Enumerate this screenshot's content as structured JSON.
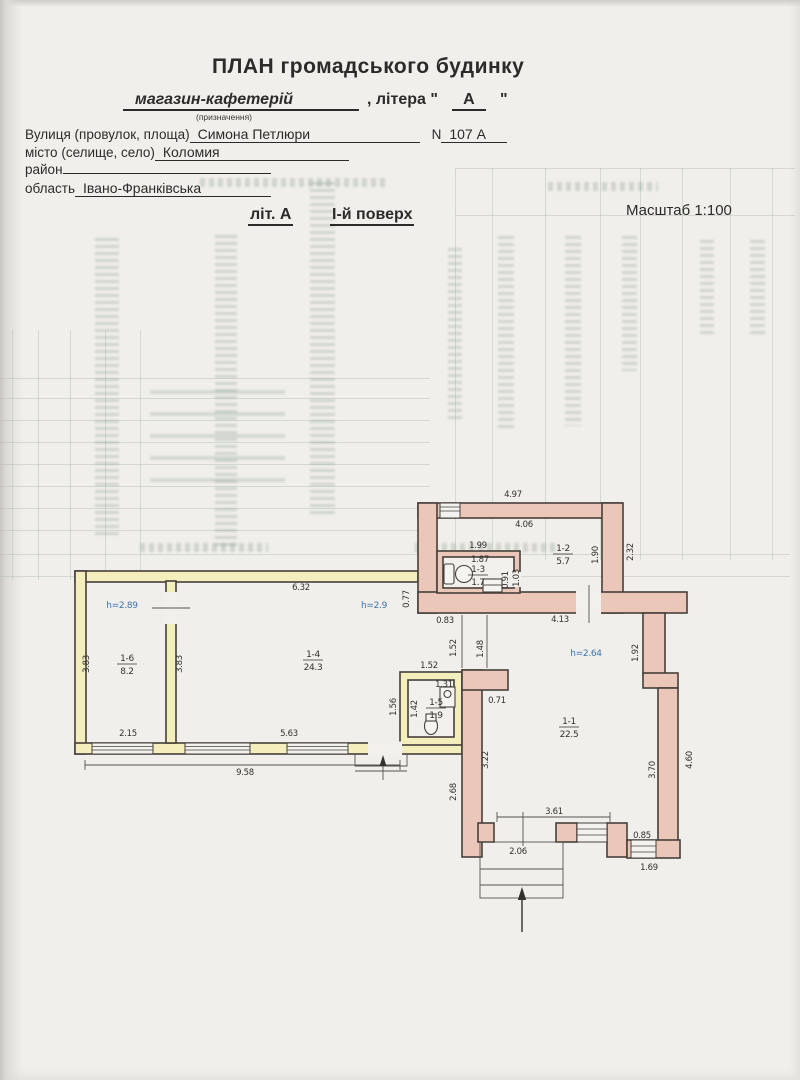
{
  "header": {
    "title": "ПЛАН  громадського будинку",
    "purpose_value": "магазин-кафетерій",
    "purpose_caption": "(призначення)",
    "letter_prefix": ", літера \"",
    "letter_value": "А",
    "letter_suffix": "\"",
    "street_label": "Вулиця (провулок, площа)",
    "street_value": "Симона Петлюри",
    "number_label": "N",
    "number_value": "107 А",
    "city_label": "місто (селище, село)",
    "city_value": "Коломия",
    "district_label": "район",
    "district_value": "",
    "region_label": "область",
    "region_value": "Івано-Франківська"
  },
  "subtitle": {
    "sheet_label": "літ. А",
    "floor_label": "І-й поверх",
    "scale_label": "Масштаб 1:100"
  },
  "plan": {
    "colors": {
      "wall_pink": "#ebc7ba",
      "wall_yellow": "#f3eebc",
      "height_text": "#3f74a6"
    },
    "rooms": [
      {
        "number": "1-1",
        "area": "22.5",
        "x": 569,
        "y": 724
      },
      {
        "number": "1-2",
        "area": "5.7",
        "x": 563,
        "y": 551
      },
      {
        "number": "1-3",
        "area": "1.7",
        "x": 478,
        "y": 572
      },
      {
        "number": "1-4",
        "area": "24.3",
        "x": 313,
        "y": 657
      },
      {
        "number": "1-5",
        "area": "1.9",
        "x": 436,
        "y": 705
      },
      {
        "number": "1-6",
        "area": "8.2",
        "x": 127,
        "y": 661
      }
    ],
    "labels": [
      {
        "t": "4.97",
        "x": 513,
        "y": 497
      },
      {
        "t": "4.06",
        "x": 524,
        "y": 527
      },
      {
        "t": "1.99",
        "x": 478,
        "y": 548
      },
      {
        "t": "1.87",
        "x": 480,
        "y": 562
      },
      {
        "t": "0.91",
        "x": 508,
        "y": 580,
        "o": "v"
      },
      {
        "t": "1.03",
        "x": 519,
        "y": 578,
        "o": "v"
      },
      {
        "t": "1.90",
        "x": 598,
        "y": 555,
        "o": "v"
      },
      {
        "t": "2.32",
        "x": 633,
        "y": 552,
        "o": "v"
      },
      {
        "t": "0.77",
        "x": 409,
        "y": 599,
        "o": "v"
      },
      {
        "t": "0.83",
        "x": 445,
        "y": 623
      },
      {
        "t": "4.13",
        "x": 560,
        "y": 622
      },
      {
        "t": "1.52",
        "x": 456,
        "y": 648,
        "o": "v"
      },
      {
        "t": "1.48",
        "x": 483,
        "y": 649,
        "o": "v"
      },
      {
        "t": "1.92",
        "x": 638,
        "y": 653,
        "o": "v"
      },
      {
        "t": "h=2.64",
        "x": 586,
        "y": 656,
        "c": "blue"
      },
      {
        "t": "0.71",
        "x": 497,
        "y": 703
      },
      {
        "t": "1.52",
        "x": 429,
        "y": 668
      },
      {
        "t": "1.31",
        "x": 444,
        "y": 687
      },
      {
        "t": "1.42",
        "x": 417,
        "y": 709,
        "o": "v"
      },
      {
        "t": "1.56",
        "x": 396,
        "y": 707,
        "o": "v"
      },
      {
        "t": "3.22",
        "x": 488,
        "y": 760,
        "o": "v"
      },
      {
        "t": "2.68",
        "x": 456,
        "y": 792,
        "o": "v"
      },
      {
        "t": "3.70",
        "x": 655,
        "y": 770,
        "o": "v"
      },
      {
        "t": "4.60",
        "x": 692,
        "y": 760,
        "o": "v"
      },
      {
        "t": "3.61",
        "x": 554,
        "y": 814
      },
      {
        "t": "2.06",
        "x": 518,
        "y": 854
      },
      {
        "t": "0.85",
        "x": 642,
        "y": 838
      },
      {
        "t": "1.69",
        "x": 649,
        "y": 870
      },
      {
        "t": "6.32",
        "x": 301,
        "y": 590
      },
      {
        "t": "h=2.9",
        "x": 374,
        "y": 608,
        "c": "blue"
      },
      {
        "t": "h=2.89",
        "x": 122,
        "y": 608,
        "c": "blue"
      },
      {
        "t": "3.83",
        "x": 89,
        "y": 664,
        "o": "v"
      },
      {
        "t": "3.83",
        "x": 182,
        "y": 664,
        "o": "v"
      },
      {
        "t": "2.15",
        "x": 128,
        "y": 736
      },
      {
        "t": "5.63",
        "x": 289,
        "y": 736
      },
      {
        "t": "9.58",
        "x": 245,
        "y": 775
      }
    ]
  }
}
